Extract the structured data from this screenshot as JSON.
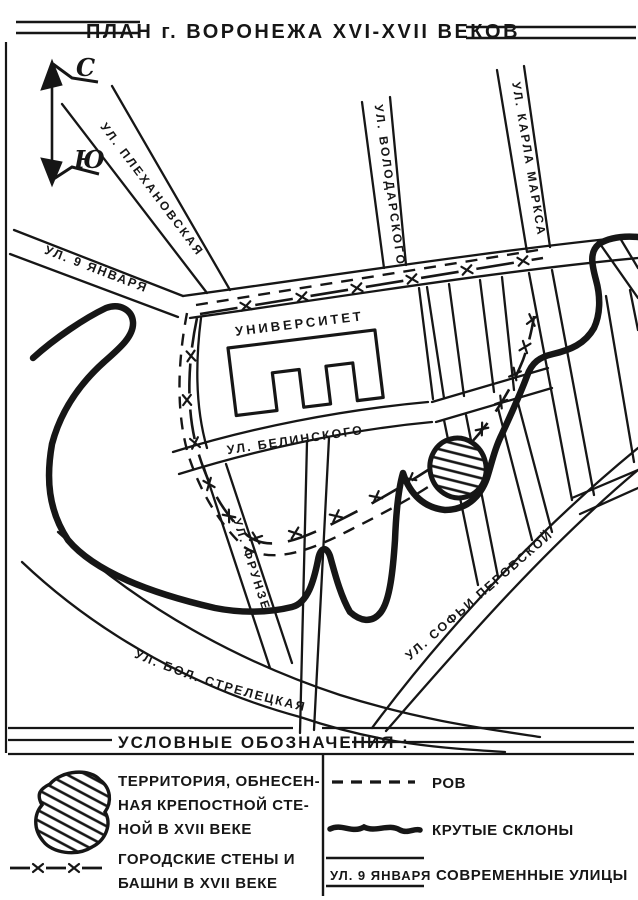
{
  "title": "ПЛАН г. ВОРОНЕЖА XVI-XVII ВЕКОВ",
  "compass": {
    "north": "С",
    "south": "Ю"
  },
  "map": {
    "streets": {
      "yanvarya": "УЛ. 9 ЯНВАРЯ",
      "plekhanovskaya": "УЛ. ПЛЕХАНОВСКАЯ",
      "volodarskogo": "УЛ. ВОЛОДАРСКОГО",
      "karla_marksa": "УЛ. КАРЛА МАРКСА",
      "belinskogo": "УЛ. БЕЛИНСКОГО",
      "frunze": "УЛ. ФРУНЗЕ",
      "sofyi_perovskoy": "УЛ. СОФЬИ ПЕРОВСКОЙ",
      "bolshaya_streletskaya": "УЛ. БОЛ. СТРЕЛЕЦКАЯ"
    },
    "landmarks": {
      "university": "УНИВЕРСИТЕТ"
    }
  },
  "legend": {
    "heading": "УСЛОВНЫЕ ОБОЗНАЧЕНИЯ :",
    "items": [
      {
        "symbol": "hatched-area-symbol",
        "lines": [
          "ТЕРРИТОРИЯ, ОБНЕСЕН-",
          "НАЯ КРЕПОСТНОЙ СТЕ-",
          "НОЙ В XVII ВЕКЕ"
        ]
      },
      {
        "symbol": "wall-towers-symbol",
        "lines": [
          "ГОРОДСКИЕ СТЕНЫ И",
          "БАШНИ В XVII ВЕКЕ"
        ]
      },
      {
        "symbol": "dashed-line-symbol",
        "label": "РОВ"
      },
      {
        "symbol": "thick-line-symbol",
        "label": "КРУТЫЕ СКЛОНЫ"
      },
      {
        "symbol_text": "УЛ. 9 ЯНВАРЯ",
        "label": "СОВРЕМЕННЫЕ УЛИЦЫ"
      }
    ]
  },
  "colors": {
    "ink": "#161616",
    "paper": "#ffffff"
  }
}
